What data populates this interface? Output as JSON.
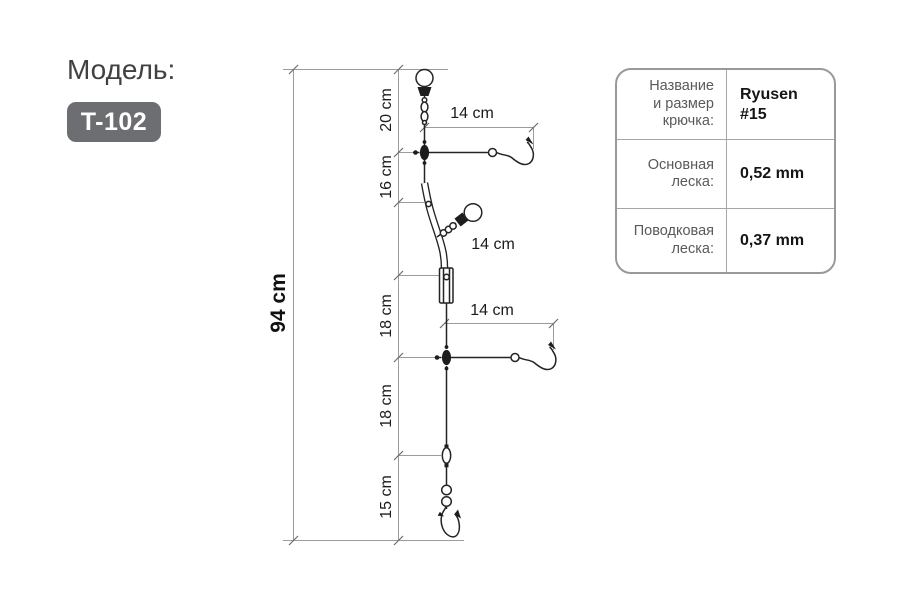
{
  "header": {
    "model_label": "Модель:",
    "model_code": "T-102"
  },
  "diagram": {
    "total_length_label": "94 cm",
    "segment_labels": [
      "20 cm",
      "16 cm",
      "18 cm",
      "18 cm",
      "15 cm"
    ],
    "leader_labels": [
      "14 cm",
      "14 cm",
      "14 cm"
    ]
  },
  "table": {
    "rows": [
      {
        "label": "Название\nи размер\nкрючка:",
        "value": "Ryusen\n#15"
      },
      {
        "label": "Основная\nлеска:",
        "value": "0,52 mm"
      },
      {
        "label": "Поводковая\nлеска:",
        "value": "0,37 mm"
      }
    ]
  }
}
